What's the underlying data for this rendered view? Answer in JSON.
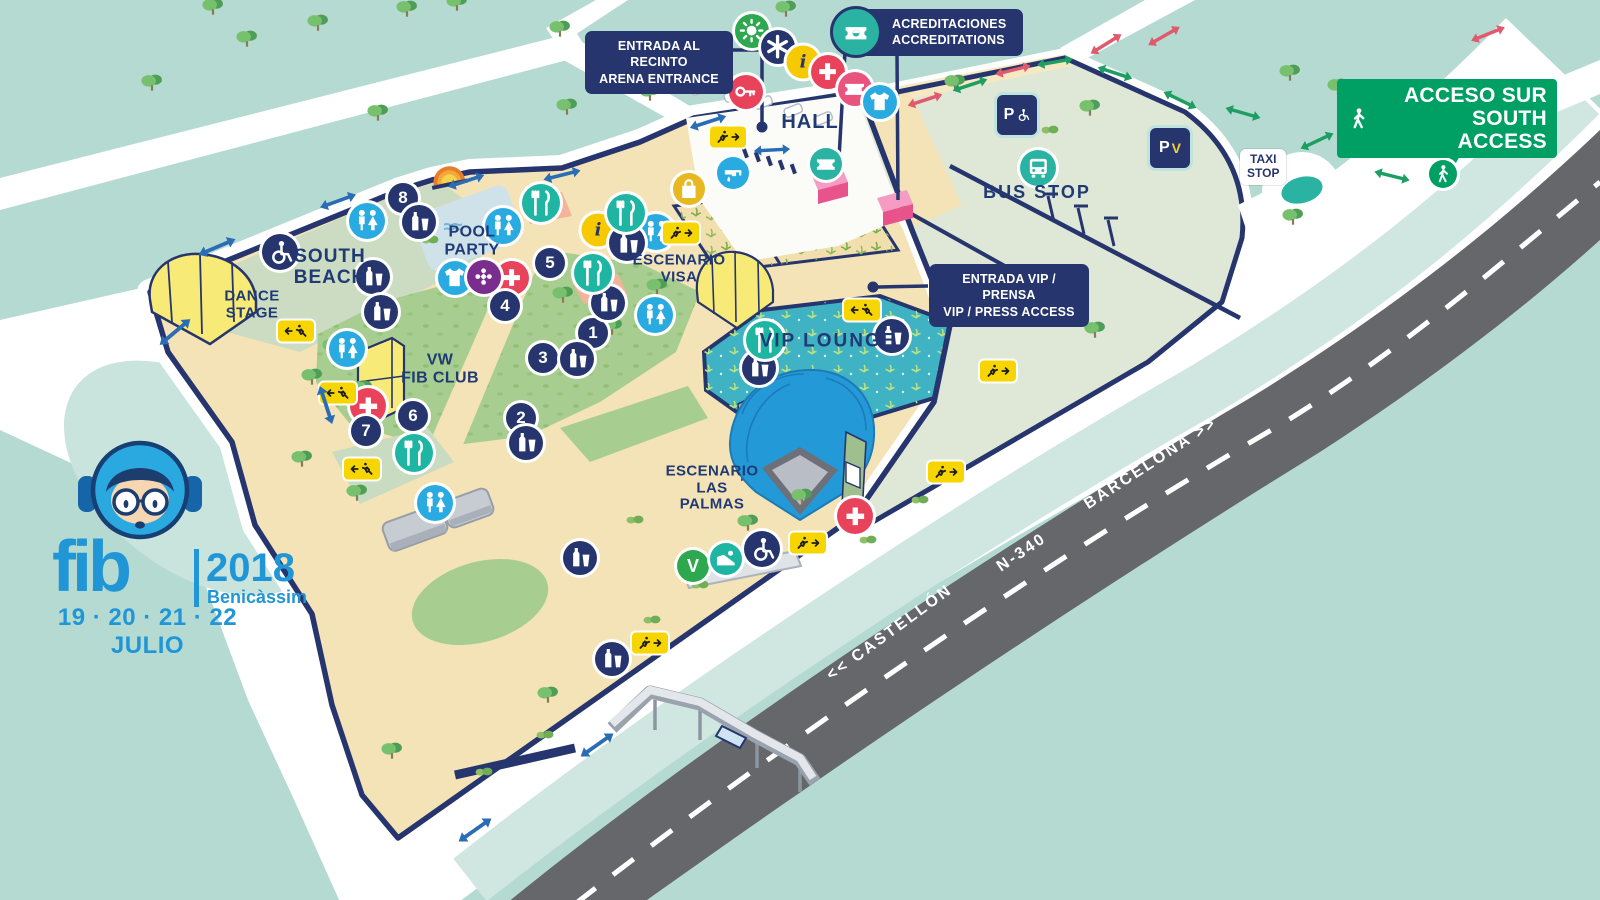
{
  "map": {
    "callouts": {
      "arena": "ENTRADA AL RECINTO\nARENA ENTRANCE",
      "accred": "ACREDITACIONES\nACCREDITATIONS",
      "vip": "ENTRADA VIP / PRENSA\nVIP / PRESS ACCESS",
      "south_access": "ACCESO SUR\nSOUTH ACCESS",
      "taxi": "TAXI\nSTOP"
    },
    "places": {
      "hall": "HALL",
      "bus": "BUS STOP",
      "pool": "POOL\nPARTY",
      "south_beach": "SOUTH\nBEACH",
      "dance": "DANCE\nSTAGE",
      "vw": "VW\nFIB CLUB",
      "visa": "ESCENARIO\nVISA",
      "palmas": "ESCENARIO\nLAS\nPALMAS",
      "vip_lounge": "VIP LOUNGE"
    },
    "road": {
      "castellon": "<< CASTELLÓN",
      "n340": "N-340",
      "barcelona": "BARCELONA >>"
    },
    "logo": {
      "fib": "fib",
      "year": "2018",
      "city": "Benicàssim",
      "dates": "19 · 20 · 21 · 22 JULIO"
    },
    "colors": {
      "background": "#b5dad2",
      "navy": "#26356d",
      "sand": "#f4e3b6",
      "grass": "#a8cd90",
      "parking": "#dfe8d6",
      "vip": "#3fb3c4",
      "road": "#65676b",
      "accent_blue": "#29abe2",
      "accent_teal": "#2ab3a3",
      "accent_red": "#e8435a",
      "accent_yellow": "#f7c900",
      "access_green": "#00a065",
      "logo_blue": "#2196d6"
    },
    "icons": [
      {
        "n": "sun-icon",
        "g": "sun",
        "c": "#2ea84f",
        "x": 752,
        "y": 31,
        "s": 34
      },
      {
        "n": "star-icon",
        "g": "star",
        "c": "#26356d",
        "x": 778,
        "y": 47,
        "s": 34
      },
      {
        "n": "info-icon",
        "t": "num",
        "cls": "info",
        "txt": "i",
        "c": "#f7c900",
        "x": 803,
        "y": 62,
        "s": 33
      },
      {
        "n": "info-icon",
        "t": "num",
        "cls": "info",
        "txt": "i",
        "c": "#f7c900",
        "x": 598,
        "y": 230,
        "s": 33
      },
      {
        "n": "first-aid-icon",
        "g": "cross",
        "c": "#e8435a",
        "x": 828,
        "y": 72,
        "s": 34
      },
      {
        "n": "first-aid-icon",
        "g": "cross",
        "c": "#e8435a",
        "x": 512,
        "y": 278,
        "s": 34
      },
      {
        "n": "first-aid-icon",
        "g": "cross",
        "c": "#e8435a",
        "x": 368,
        "y": 406,
        "s": 36
      },
      {
        "n": "first-aid-icon",
        "g": "cross",
        "c": "#e8435a",
        "x": 855,
        "y": 516,
        "s": 36
      },
      {
        "n": "ticket-office-icon",
        "g": "ticket",
        "c": "#e8547e",
        "x": 855,
        "y": 89,
        "s": 34
      },
      {
        "n": "ticket-icon",
        "g": "ticket",
        "c": "#2ab3a3",
        "x": 826,
        "y": 164,
        "s": 32
      },
      {
        "n": "merch-icon",
        "g": "tshirt",
        "c": "#29abe2",
        "gf": "#f7d232",
        "x": 880,
        "y": 102,
        "s": 34
      },
      {
        "n": "merch-icon",
        "g": "tshirt",
        "c": "#29abe2",
        "gf": "#f7d232",
        "x": 455,
        "y": 278,
        "s": 34
      },
      {
        "n": "key-icon",
        "g": "key",
        "c": "#e8435a",
        "x": 746,
        "y": 92,
        "s": 34
      },
      {
        "n": "water-icon",
        "g": "tap",
        "c": "#29abe2",
        "x": 733,
        "y": 173,
        "s": 32
      },
      {
        "n": "shop-icon",
        "g": "bag",
        "c": "#e8b820",
        "x": 689,
        "y": 189,
        "s": 32
      },
      {
        "n": "games-icon",
        "g": "flower",
        "c": "#7b2d8e",
        "x": 484,
        "y": 277,
        "s": 34
      },
      {
        "n": "poi-8",
        "t": "num",
        "txt": "8",
        "c": "#26356d",
        "x": 403,
        "y": 198,
        "s": 30
      },
      {
        "n": "poi-5",
        "t": "num",
        "txt": "5",
        "c": "#26356d",
        "x": 550,
        "y": 263,
        "s": 30
      },
      {
        "n": "poi-4",
        "t": "num",
        "txt": "4",
        "c": "#26356d",
        "x": 505,
        "y": 306,
        "s": 30
      },
      {
        "n": "poi-1",
        "t": "num",
        "txt": "1",
        "c": "#26356d",
        "x": 593,
        "y": 333,
        "s": 30
      },
      {
        "n": "poi-3",
        "t": "num",
        "txt": "3",
        "c": "#26356d",
        "x": 543,
        "y": 358,
        "s": 30
      },
      {
        "n": "poi-2",
        "t": "num",
        "txt": "2",
        "c": "#26356d",
        "x": 521,
        "y": 418,
        "s": 30
      },
      {
        "n": "poi-6",
        "t": "num",
        "txt": "6",
        "c": "#26356d",
        "x": 413,
        "y": 416,
        "s": 30
      },
      {
        "n": "poi-7",
        "t": "num",
        "txt": "7",
        "c": "#26356d",
        "x": 366,
        "y": 431,
        "s": 30
      },
      {
        "n": "restroom-icon",
        "g": "restroom",
        "c": "#29abe2",
        "x": 367,
        "y": 221,
        "s": 36
      },
      {
        "n": "restroom-icon",
        "g": "restroom",
        "c": "#29abe2",
        "x": 503,
        "y": 226,
        "s": 36
      },
      {
        "n": "restroom-icon",
        "g": "restroom",
        "c": "#29abe2",
        "x": 656,
        "y": 232,
        "s": 36
      },
      {
        "n": "restroom-icon",
        "g": "restroom",
        "c": "#29abe2",
        "x": 655,
        "y": 315,
        "s": 36
      },
      {
        "n": "restroom-icon",
        "g": "restroom",
        "c": "#29abe2",
        "x": 347,
        "y": 349,
        "s": 36
      },
      {
        "n": "restroom-icon",
        "g": "restroom",
        "c": "#29abe2",
        "x": 435,
        "y": 503,
        "s": 36
      },
      {
        "n": "bar-icon",
        "g": "drink",
        "c": "#26356d",
        "x": 419,
        "y": 222,
        "s": 34
      },
      {
        "n": "bar-icon",
        "g": "drink",
        "c": "#26356d",
        "x": 373,
        "y": 277,
        "s": 34
      },
      {
        "n": "bar-icon",
        "g": "drink",
        "c": "#26356d",
        "x": 381,
        "y": 312,
        "s": 34
      },
      {
        "n": "bar-icon",
        "g": "drink",
        "c": "#26356d",
        "x": 627,
        "y": 243,
        "s": 36
      },
      {
        "n": "bar-icon",
        "g": "drink",
        "c": "#26356d",
        "x": 608,
        "y": 303,
        "s": 34
      },
      {
        "n": "bar-icon",
        "g": "drink",
        "c": "#26356d",
        "x": 577,
        "y": 359,
        "s": 34
      },
      {
        "n": "bar-icon",
        "g": "drink",
        "c": "#26356d",
        "x": 526,
        "y": 443,
        "s": 34
      },
      {
        "n": "bar-icon",
        "g": "drink",
        "c": "#26356d",
        "x": 580,
        "y": 558,
        "s": 34
      },
      {
        "n": "bar-icon",
        "g": "drink",
        "c": "#26356d",
        "x": 612,
        "y": 659,
        "s": 34
      },
      {
        "n": "bar-icon",
        "g": "drink",
        "c": "#26356d",
        "x": 892,
        "y": 336,
        "s": 34
      },
      {
        "n": "bar-icon",
        "g": "drink",
        "c": "#26356d",
        "x": 759,
        "y": 368,
        "s": 34
      },
      {
        "n": "food-icon",
        "g": "food",
        "c": "#1fb5a3",
        "x": 541,
        "y": 203,
        "s": 38
      },
      {
        "n": "food-icon",
        "g": "food",
        "c": "#1fb5a3",
        "x": 626,
        "y": 213,
        "s": 38
      },
      {
        "n": "food-icon",
        "g": "food",
        "c": "#1fb5a3",
        "x": 593,
        "y": 273,
        "s": 38
      },
      {
        "n": "food-icon",
        "g": "food",
        "c": "#1fb5a3",
        "x": 414,
        "y": 453,
        "s": 38
      },
      {
        "n": "food-icon",
        "g": "food",
        "c": "#1fb5a3",
        "x": 765,
        "y": 340,
        "s": 38
      },
      {
        "n": "accessibility-icon",
        "g": "wheelchair",
        "c": "#26356d",
        "x": 280,
        "y": 252,
        "s": 36
      },
      {
        "n": "accessibility-icon",
        "g": "wheelchair",
        "c": "#26356d",
        "x": 762,
        "y": 549,
        "s": 36
      },
      {
        "n": "vegetarian-icon",
        "t": "num",
        "txt": "V",
        "c": "#2ea84f",
        "x": 693,
        "y": 566,
        "s": 32
      },
      {
        "n": "ramp-icon",
        "g": "ramp",
        "c": "#1fb5a3",
        "x": 726,
        "y": 559,
        "s": 32
      },
      {
        "n": "bus-stop-icon",
        "g": "bus",
        "c": "#2ab3a3",
        "x": 1038,
        "y": 168,
        "s": 36
      },
      {
        "n": "pedestrian-icon",
        "g": "walker",
        "c": "#00a065",
        "x": 1443,
        "y": 174,
        "s": 28
      },
      {
        "n": "parking-accessible-icon",
        "t": "park",
        "sub": "acc",
        "x": 1017,
        "y": 115,
        "s": 40
      },
      {
        "n": "parking-vip-icon",
        "t": "park",
        "sub": "vip",
        "x": 1170,
        "y": 148,
        "s": 40
      },
      {
        "n": "emergency-exit-icon",
        "t": "exit",
        "x": 728,
        "y": 137,
        "f": 0
      },
      {
        "n": "emergency-exit-icon",
        "t": "exit",
        "x": 681,
        "y": 233,
        "f": 0
      },
      {
        "n": "emergency-exit-icon",
        "t": "exit",
        "x": 296,
        "y": 331,
        "f": 1
      },
      {
        "n": "emergency-exit-icon",
        "t": "exit",
        "x": 338,
        "y": 393,
        "f": 1
      },
      {
        "n": "emergency-exit-icon",
        "t": "exit",
        "x": 362,
        "y": 469,
        "f": 1
      },
      {
        "n": "emergency-exit-icon",
        "t": "exit",
        "x": 862,
        "y": 310,
        "f": 1
      },
      {
        "n": "emergency-exit-icon",
        "t": "exit",
        "x": 998,
        "y": 371,
        "f": 0
      },
      {
        "n": "emergency-exit-icon",
        "t": "exit",
        "x": 946,
        "y": 472,
        "f": 0
      },
      {
        "n": "emergency-exit-icon",
        "t": "exit",
        "x": 808,
        "y": 543,
        "f": 0
      },
      {
        "n": "emergency-exit-icon",
        "t": "exit",
        "x": 650,
        "y": 643,
        "f": 0
      },
      {
        "n": "two-way-arrow",
        "t": "dar",
        "c": "#2a6db5",
        "x": 217,
        "y": 247,
        "r": -23,
        "s": 44
      },
      {
        "n": "two-way-arrow",
        "t": "dar",
        "c": "#2a6db5",
        "x": 175,
        "y": 332,
        "r": -40,
        "s": 44
      },
      {
        "n": "two-way-arrow",
        "t": "dar",
        "c": "#2a6db5",
        "x": 326,
        "y": 405,
        "r": 72,
        "s": 44
      },
      {
        "n": "two-way-arrow",
        "t": "dar",
        "c": "#2a6db5",
        "x": 338,
        "y": 201,
        "r": -20,
        "s": 42
      },
      {
        "n": "two-way-arrow",
        "t": "dar",
        "c": "#2a6db5",
        "x": 466,
        "y": 181,
        "r": -18,
        "s": 42
      },
      {
        "n": "two-way-arrow",
        "t": "dar",
        "c": "#2a6db5",
        "x": 562,
        "y": 175,
        "r": -14,
        "s": 42
      },
      {
        "n": "two-way-arrow",
        "t": "dar",
        "c": "#2a6db5",
        "x": 708,
        "y": 122,
        "r": -18,
        "s": 42
      },
      {
        "n": "two-way-arrow",
        "t": "dar",
        "c": "#2a6db5",
        "x": 772,
        "y": 150,
        "r": -3,
        "s": 40
      },
      {
        "n": "two-way-arrow",
        "t": "dar",
        "c": "#2a6db5",
        "x": 597,
        "y": 745,
        "r": -35,
        "s": 44
      },
      {
        "n": "two-way-arrow",
        "t": "dar",
        "c": "#2a6db5",
        "x": 475,
        "y": 830,
        "r": -35,
        "s": 44
      },
      {
        "n": "two-way-arrow",
        "t": "dar",
        "c": "#1f9e63",
        "x": 970,
        "y": 85,
        "r": -18,
        "s": 40
      },
      {
        "n": "two-way-arrow",
        "t": "dar",
        "c": "#1f9e63",
        "x": 1055,
        "y": 62,
        "r": -10,
        "s": 40
      },
      {
        "n": "two-way-arrow",
        "t": "dar",
        "c": "#1f9e63",
        "x": 1115,
        "y": 73,
        "r": 18,
        "s": 40
      },
      {
        "n": "two-way-arrow",
        "t": "dar",
        "c": "#1f9e63",
        "x": 1180,
        "y": 100,
        "r": 26,
        "s": 40
      },
      {
        "n": "two-way-arrow",
        "t": "dar",
        "c": "#1f9e63",
        "x": 1243,
        "y": 113,
        "r": 16,
        "s": 40
      },
      {
        "n": "two-way-arrow",
        "t": "dar",
        "c": "#1f9e63",
        "x": 1317,
        "y": 141,
        "r": -25,
        "s": 40
      },
      {
        "n": "two-way-arrow",
        "t": "dar",
        "c": "#1f9e63",
        "x": 1392,
        "y": 176,
        "r": 14,
        "s": 40
      },
      {
        "n": "two-way-arrow",
        "t": "dar",
        "c": "#e05a6e",
        "x": 925,
        "y": 100,
        "r": -18,
        "s": 40
      },
      {
        "n": "two-way-arrow",
        "t": "dar",
        "c": "#e05a6e",
        "x": 1013,
        "y": 70,
        "r": -14,
        "s": 40
      },
      {
        "n": "two-way-arrow",
        "t": "dar",
        "c": "#e05a6e",
        "x": 1106,
        "y": 44,
        "r": -32,
        "s": 40
      },
      {
        "n": "two-way-arrow",
        "t": "dar",
        "c": "#e05a6e",
        "x": 1164,
        "y": 36,
        "r": -30,
        "s": 40
      },
      {
        "n": "two-way-arrow",
        "t": "dar",
        "c": "#e05a6e",
        "x": 1488,
        "y": 34,
        "r": -22,
        "s": 40
      },
      {
        "n": "pool-waves",
        "t": "wave",
        "txt": "≈≈",
        "x": 452,
        "y": 228,
        "s": 22
      }
    ],
    "trees": [
      [
        213,
        12
      ],
      [
        247,
        44
      ],
      [
        318,
        28
      ],
      [
        407,
        14
      ],
      [
        457,
        8
      ],
      [
        560,
        34
      ],
      [
        152,
        88
      ],
      [
        378,
        118
      ],
      [
        567,
        112
      ],
      [
        650,
        98
      ],
      [
        786,
        14
      ],
      [
        876,
        40
      ],
      [
        955,
        88
      ],
      [
        1090,
        113
      ],
      [
        1290,
        78
      ],
      [
        1338,
        92
      ],
      [
        1293,
        222
      ],
      [
        1095,
        335
      ],
      [
        333,
        352
      ],
      [
        312,
        382
      ],
      [
        362,
        394
      ],
      [
        563,
        300
      ],
      [
        612,
        332
      ],
      [
        657,
        292
      ],
      [
        302,
        464
      ],
      [
        357,
        498
      ],
      [
        392,
        756
      ],
      [
        548,
        700
      ],
      [
        748,
        528
      ],
      [
        802,
        502
      ]
    ],
    "bushes": [
      [
        920,
        500
      ],
      [
        868,
        540
      ],
      [
        700,
        585
      ],
      [
        652,
        620
      ],
      [
        545,
        735
      ],
      [
        484,
        772
      ],
      [
        635,
        520
      ],
      [
        1050,
        130
      ],
      [
        430,
        240
      ]
    ]
  }
}
